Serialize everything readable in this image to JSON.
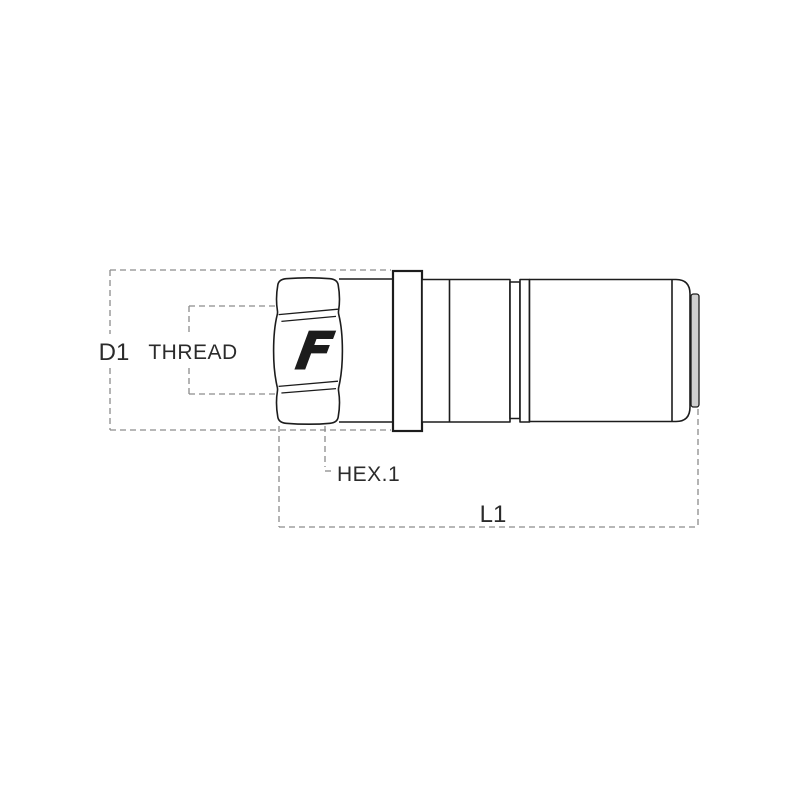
{
  "drawing": {
    "title": "quick-coupling-dimension-drawing",
    "labels": {
      "d1": "D1",
      "thread": "THREAD",
      "hex1": "HEX.1",
      "l1": "L1"
    },
    "logo": "F",
    "colors": {
      "outline": "#1c1c1c",
      "dashed_dimension": "#8c8c8c",
      "label_text": "#2b2b2b",
      "end_cap_fill": "#cfcfcf",
      "background": "#ffffff"
    }
  }
}
